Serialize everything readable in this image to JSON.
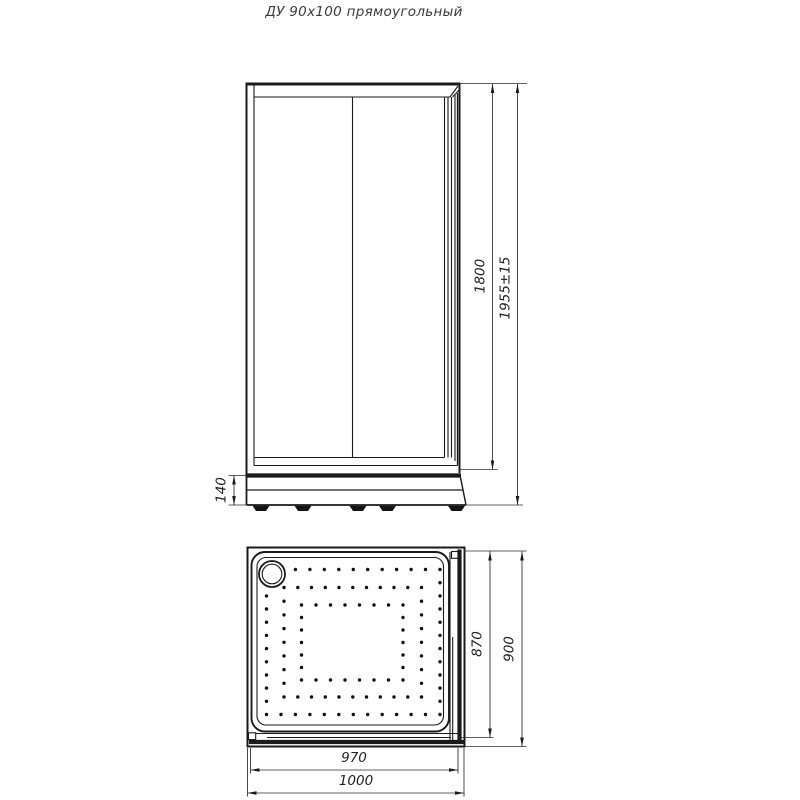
{
  "title": "ДУ 90х100 прямоугольный",
  "colors": {
    "line": "#1a1a1a",
    "text": "#333333",
    "background": "#ffffff"
  },
  "front_view": {
    "label": "front elevation of shower enclosure",
    "dimensions": {
      "door_frame_height": "1800",
      "total_height": "1955±15",
      "tray_height": "140"
    }
  },
  "top_view": {
    "label": "plan view of shower tray",
    "dimensions": {
      "tray_inner_depth": "870",
      "tray_outer_depth": "900",
      "tray_inner_width": "970",
      "tray_outer_width": "1000"
    }
  }
}
